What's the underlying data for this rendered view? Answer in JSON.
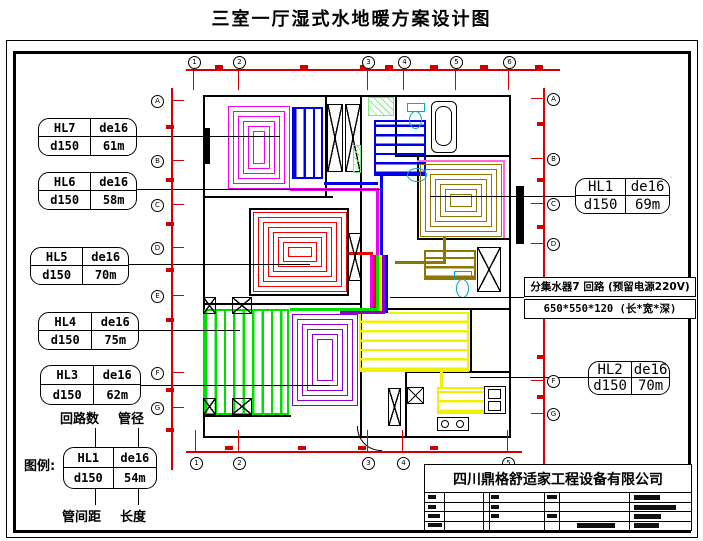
{
  "title": "三室一厅湿式水地暖方案设计图",
  "manifold_box": {
    "line1": "分集水器7 回路 (预留电源220V)",
    "line2": "650*550*120 (长*宽*深)"
  },
  "legend": {
    "prefix": "图例:",
    "top_left": "回路数",
    "top_right": "管径",
    "bottom_left": "管间距",
    "bottom_right": "长度"
  },
  "title_block": {
    "company": "四川鼎格舒适家工程设备有限公司",
    "bars": [
      [
        209,
        30,
        26,
        5
      ],
      [
        209,
        40,
        42,
        5
      ],
      [
        209,
        49,
        27,
        5
      ],
      [
        209,
        58,
        25,
        5
      ],
      [
        152,
        58,
        38,
        5
      ],
      [
        3,
        58,
        14,
        4
      ],
      [
        3,
        49,
        12,
        4
      ],
      [
        3,
        30,
        8,
        4
      ],
      [
        3,
        40,
        8,
        4
      ],
      [
        66,
        30,
        8,
        4
      ],
      [
        66,
        40,
        8,
        4
      ],
      [
        66,
        49,
        8,
        4
      ],
      [
        122,
        30,
        10,
        4
      ],
      [
        122,
        49,
        10,
        4
      ]
    ]
  },
  "colors": {
    "dim": "#d40000",
    "magenta": "#f000f0",
    "blue": "#0000e8",
    "olive": "#8f7600",
    "red": "#f00000",
    "green": "#00dd00",
    "purple": "#8e00d0",
    "yellow": "#f0f000",
    "cyan": "#00a8c8",
    "pink": "#ff6ad5",
    "lightgreen": "#7ce87c"
  },
  "loop_labels": [
    {
      "id": "HL7",
      "pipe": "de16",
      "spacing": "d150",
      "length": "61m",
      "x": 38,
      "y": 118,
      "w": 97,
      "h": 36,
      "big": false
    },
    {
      "id": "HL6",
      "pipe": "de16",
      "spacing": "d150",
      "length": "58m",
      "x": 38,
      "y": 172,
      "w": 97,
      "h": 36,
      "big": false
    },
    {
      "id": "HL5",
      "pipe": "de16",
      "spacing": "d150",
      "length": "70m",
      "x": 30,
      "y": 247,
      "w": 97,
      "h": 36,
      "big": false
    },
    {
      "id": "HL4",
      "pipe": "de16",
      "spacing": "d150",
      "length": "75m",
      "x": 38,
      "y": 312,
      "w": 99,
      "h": 36,
      "big": false
    },
    {
      "id": "HL3",
      "pipe": "de16",
      "spacing": "d150",
      "length": "62m",
      "x": 40,
      "y": 365,
      "w": 99,
      "h": 38,
      "big": false
    },
    {
      "id": "HL1",
      "pipe": "de16",
      "spacing": "d150",
      "length": "69m",
      "x": 575,
      "y": 178,
      "w": 93,
      "h": 34,
      "big": true
    },
    {
      "id": "HL2",
      "pipe": "de16",
      "spacing": "d150",
      "length": "70m",
      "x": 588,
      "y": 361,
      "w": 80,
      "h": 32,
      "big": true
    },
    {
      "id": "HL1",
      "pipe": "de16",
      "spacing": "d150",
      "length": "54m",
      "x": 63,
      "y": 447,
      "w": 92,
      "h": 40,
      "big": false,
      "legend": true
    }
  ],
  "axes": {
    "top": {
      "y": 56,
      "labels": [
        "1",
        "2",
        "3",
        "4",
        "5",
        "6"
      ],
      "xs": [
        193,
        238,
        367,
        403,
        455,
        508
      ]
    },
    "bottom": {
      "y": 457,
      "labels": [
        "1",
        "2",
        "3",
        "4",
        "5"
      ],
      "xs": [
        195,
        238,
        367,
        402,
        507
      ]
    },
    "left": {
      "x": 151,
      "labels": [
        "A",
        "B",
        "C",
        "D",
        "E",
        "F",
        "G"
      ],
      "ys": [
        95,
        155,
        199,
        242,
        290,
        367,
        402
      ]
    },
    "right": {
      "x": 547,
      "labels": [
        "A",
        "B",
        "C",
        "D",
        "F",
        "G"
      ],
      "ys": [
        93,
        153,
        198,
        238,
        375,
        408
      ]
    }
  },
  "plan": {
    "coils": [
      {
        "name": "bedroom-nw-coil",
        "type": "spiral",
        "x": 228,
        "y": 106,
        "w": 62,
        "h": 83,
        "c": "magenta"
      },
      {
        "name": "study-coil",
        "type": "serp-v",
        "x": 292,
        "y": 107,
        "w": 31,
        "h": 72,
        "c": "blue"
      },
      {
        "name": "bathroom-coil",
        "type": "serp-h",
        "x": 374,
        "y": 120,
        "w": 52,
        "h": 56,
        "c": "blue"
      },
      {
        "name": "bedroom-ne-coil",
        "type": "spiral",
        "x": 420,
        "y": 164,
        "w": 82,
        "h": 73,
        "c": "olive"
      },
      {
        "name": "hall-ne-coil",
        "type": "serp-h",
        "x": 424,
        "y": 250,
        "w": 52,
        "h": 30,
        "c": "olive"
      },
      {
        "name": "bedroom-w-coil",
        "type": "spiral",
        "x": 253,
        "y": 212,
        "w": 94,
        "h": 80,
        "c": "red"
      },
      {
        "name": "bedroom-sw-coil",
        "type": "serp-v",
        "x": 203,
        "y": 309,
        "w": 86,
        "h": 106,
        "c": "green"
      },
      {
        "name": "bedroom-s-coil",
        "type": "spiral",
        "x": 292,
        "y": 314,
        "w": 66,
        "h": 92,
        "c": "purple"
      },
      {
        "name": "living-room-coil",
        "type": "serp-h",
        "x": 359,
        "y": 312,
        "w": 110,
        "h": 60,
        "c": "yellow"
      },
      {
        "name": "kitchen-coil",
        "type": "serp-h",
        "x": 437,
        "y": 387,
        "w": 49,
        "h": 27,
        "c": "yellow"
      }
    ],
    "pipes": [
      {
        "x": 290,
        "y": 188,
        "w": 88,
        "h": 3,
        "c": "magenta"
      },
      {
        "x": 376,
        "y": 188,
        "w": 3,
        "h": 68,
        "c": "magenta"
      },
      {
        "x": 324,
        "y": 182,
        "w": 54,
        "h": 3,
        "c": "blue"
      },
      {
        "x": 380,
        "y": 176,
        "w": 3,
        "h": 80,
        "c": "blue"
      },
      {
        "x": 347,
        "y": 252,
        "w": 26,
        "h": 3,
        "c": "red"
      },
      {
        "x": 417,
        "y": 160,
        "w": 88,
        "h": 2,
        "c": "pink"
      },
      {
        "x": 503,
        "y": 160,
        "w": 2,
        "h": 78,
        "c": "pink"
      },
      {
        "x": 443,
        "y": 237,
        "w": 3,
        "h": 27,
        "c": "olive"
      },
      {
        "x": 395,
        "y": 261,
        "w": 51,
        "h": 3,
        "c": "olive"
      },
      {
        "x": 370,
        "y": 255,
        "w": 3,
        "h": 58,
        "c": "magenta"
      },
      {
        "x": 373,
        "y": 255,
        "w": 3,
        "h": 58,
        "c": "red"
      },
      {
        "x": 376,
        "y": 255,
        "w": 3,
        "h": 58,
        "c": "green"
      },
      {
        "x": 379,
        "y": 255,
        "w": 3,
        "h": 58,
        "c": "yellow"
      },
      {
        "x": 382,
        "y": 255,
        "w": 3,
        "h": 58,
        "c": "purple"
      },
      {
        "x": 385,
        "y": 255,
        "w": 3,
        "h": 58,
        "c": "blue"
      },
      {
        "x": 290,
        "y": 308,
        "w": 86,
        "h": 3,
        "c": "green"
      },
      {
        "x": 340,
        "y": 311,
        "w": 45,
        "h": 3,
        "c": "purple"
      },
      {
        "x": 440,
        "y": 371,
        "w": 3,
        "h": 18,
        "c": "yellow"
      }
    ],
    "walls": [
      [
        203,
        95,
        308,
        2
      ],
      [
        203,
        436,
        308,
        2
      ],
      [
        203,
        95,
        2,
        343
      ],
      [
        509,
        95,
        2,
        343
      ],
      [
        203,
        196,
        130,
        2
      ],
      [
        203,
        303,
        159,
        2
      ],
      [
        395,
        95,
        2,
        62
      ],
      [
        395,
        155,
        116,
        2
      ],
      [
        417,
        157,
        2,
        83
      ],
      [
        417,
        238,
        94,
        2
      ],
      [
        325,
        95,
        2,
        103
      ],
      [
        360,
        95,
        2,
        103
      ],
      [
        360,
        197,
        2,
        241
      ],
      [
        360,
        308,
        151,
        2
      ],
      [
        405,
        371,
        106,
        2
      ],
      [
        405,
        373,
        2,
        65
      ],
      [
        470,
        310,
        2,
        63
      ],
      [
        249,
        208,
        100,
        2
      ],
      [
        249,
        294,
        100,
        2
      ],
      [
        249,
        208,
        2,
        88
      ],
      [
        347,
        208,
        2,
        88
      ],
      [
        203,
        415,
        88,
        2
      ]
    ],
    "piers": [
      [
        203,
        128,
        7,
        36
      ],
      [
        516,
        186,
        8,
        58
      ]
    ],
    "xboxes": [
      [
        327,
        104,
        16,
        68
      ],
      [
        345,
        104,
        16,
        68
      ],
      [
        348,
        233,
        14,
        48
      ],
      [
        477,
        247,
        24,
        45
      ],
      [
        203,
        297,
        13,
        17
      ],
      [
        232,
        297,
        20,
        17
      ],
      [
        203,
        398,
        13,
        17
      ],
      [
        232,
        398,
        20,
        17
      ],
      [
        388,
        388,
        13,
        38
      ],
      [
        407,
        387,
        17,
        17
      ]
    ],
    "green_hatches": [
      [
        368,
        97,
        26,
        19
      ],
      [
        353,
        145,
        8,
        28
      ]
    ],
    "fixtures": [
      {
        "t": "tub",
        "name": "bathtub",
        "x": 431,
        "y": 101,
        "w": 24,
        "h": 50
      },
      {
        "t": "toilet",
        "name": "toilet",
        "x": 407,
        "y": 103,
        "w": 18,
        "h": 27
      },
      {
        "t": "basin",
        "name": "wash-basin",
        "x": 407,
        "y": 168,
        "w": 18,
        "h": 12
      },
      {
        "t": "toilet",
        "name": "toilet",
        "x": 454,
        "y": 271,
        "w": 18,
        "h": 28
      },
      {
        "t": "sink",
        "name": "kitchen-sink",
        "x": 484,
        "y": 386,
        "w": 20,
        "h": 26
      },
      {
        "t": "stove",
        "name": "stove",
        "x": 437,
        "y": 417,
        "w": 30,
        "h": 12
      },
      {
        "t": "door-arc",
        "name": "entry-door-arc",
        "x": 357,
        "y": 426,
        "w": 24,
        "h": 24
      }
    ],
    "leaders": [
      [
        135,
        136,
        145
      ],
      [
        135,
        189,
        245
      ],
      [
        123,
        264,
        187
      ],
      [
        137,
        330,
        103
      ],
      [
        138,
        385,
        192
      ],
      [
        430,
        196,
        145
      ],
      [
        470,
        377,
        118
      ],
      [
        390,
        297,
        134
      ]
    ],
    "red_lines": [
      [
        186,
        69,
        374,
        1.5
      ],
      [
        186,
        451,
        336,
        1.5
      ],
      [
        171,
        88,
        1.5,
        382
      ],
      [
        543,
        88,
        1.5,
        402
      ]
    ],
    "red_ticks_v": {
      "top_y": 69,
      "top_len": 21,
      "bot_y": 430,
      "bot_len": 21
    },
    "red_ticks_h": {
      "left_x": 171,
      "right_x": 531,
      "len": 13
    },
    "red_marks": {
      "top": [
        [
          215,
          65
        ],
        [
          300,
          65
        ],
        [
          360,
          65
        ],
        [
          385,
          65
        ],
        [
          430,
          65
        ],
        [
          480,
          65
        ],
        [
          535,
          65
        ]
      ],
      "bottom": [
        [
          225,
          446
        ],
        [
          298,
          446
        ],
        [
          358,
          446
        ],
        [
          430,
          446
        ]
      ],
      "left": [
        [
          166,
          125
        ],
        [
          166,
          178
        ],
        [
          166,
          222
        ],
        [
          166,
          268
        ],
        [
          166,
          318
        ],
        [
          166,
          388
        ],
        [
          166,
          428
        ]
      ],
      "right": [
        [
          537,
          122
        ],
        [
          537,
          178
        ],
        [
          537,
          225
        ],
        [
          537,
          308
        ],
        [
          537,
          355
        ],
        [
          537,
          395
        ]
      ]
    },
    "legend_connectors": [
      [
        95,
        428,
        1,
        19
      ],
      [
        138,
        428,
        1,
        19
      ],
      [
        95,
        487,
        1,
        18
      ],
      [
        138,
        487,
        1,
        18
      ]
    ]
  }
}
